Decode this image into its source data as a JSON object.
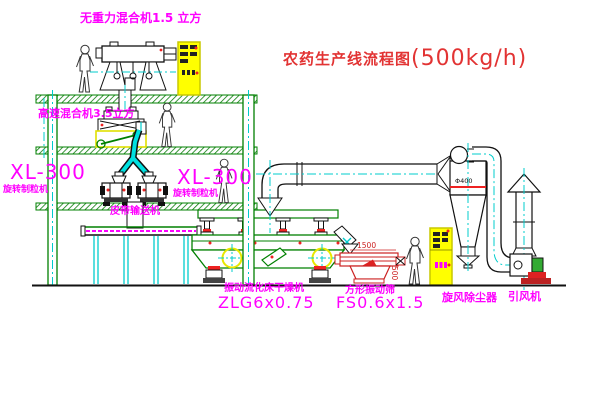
{
  "drawing": {
    "title": {
      "name": "农药生产线流程图",
      "capacity": "(500kg/h)"
    },
    "equipment_labels": {
      "gravity_mixer": "无重力混合机1.5 立方",
      "high_speed_mixer": "高速混合机3.5立方",
      "granulator_left": {
        "model": "XL-300",
        "name": "旋转制粒机"
      },
      "granulator_right": {
        "model": "XL-300",
        "name": "旋转制粒机"
      },
      "belt_conveyor": "皮带输送机",
      "fluid_bed_dryer": {
        "name": "振动流化床干燥机",
        "model": "ZLG6x0.75"
      },
      "vibrating_screen": {
        "name": "方形振动筛",
        "model": "FS0.6x1.5"
      },
      "cyclone": "旋风除尘器",
      "induced_draft_fan": "引风机"
    },
    "dimensions": {
      "screen_length": "1500",
      "screen_width": "500",
      "cyclone_inlet": "Φ400"
    },
    "colors": {
      "label_magenta": "#ff00ff",
      "title_red": "#e23333",
      "structure_green": "#008000",
      "centerline_cyan": "#00cccc",
      "cabinet_yellow": "#ffff00",
      "detail_red": "#ee2222"
    }
  }
}
